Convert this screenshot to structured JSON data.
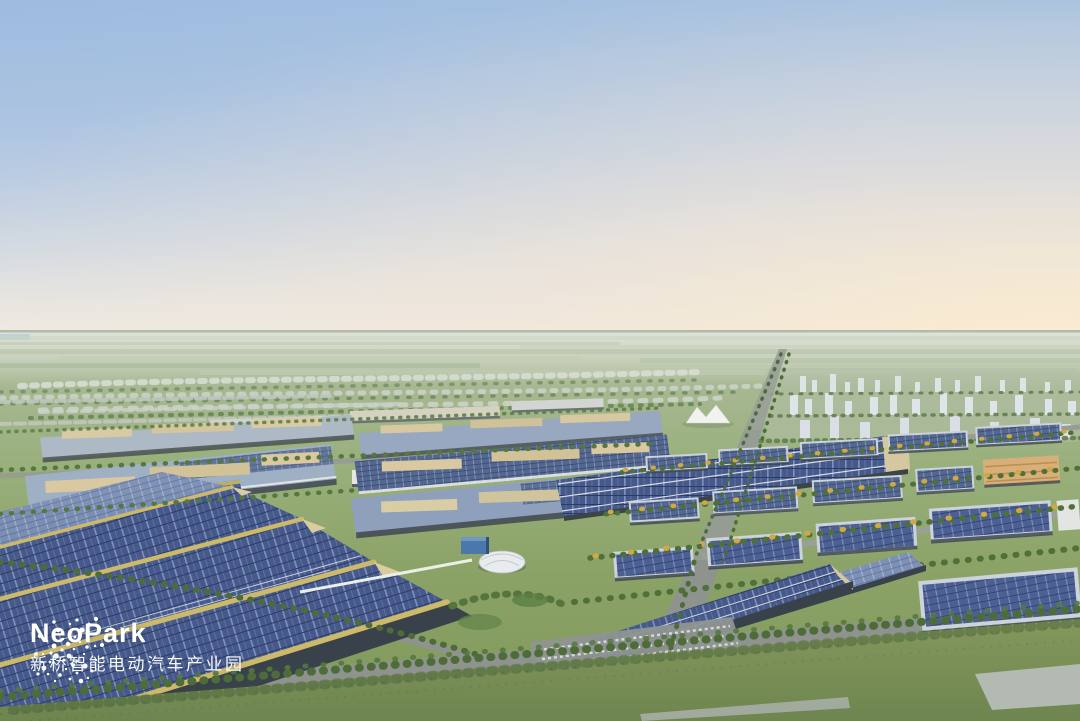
{
  "logo": {
    "title": "NeoPark",
    "subtitle": "新桥智能电动汽车产业园"
  },
  "colors": {
    "logo_white": "#ffffff",
    "sky_top": "#a9c3e1",
    "sky_horizon": "#eceae3",
    "sunset_glow": "#f9e9d2",
    "far_field": "#b9c6ab",
    "park_green": "#8aa264",
    "grass_foreground": "#7e9555",
    "tree_green": "#4d6c3a",
    "tree_autumn": "#d2a844",
    "solar_panel_dark": "#46598a",
    "solar_panel_light": "#7e93bb",
    "roof_grey_blue": "#9fb0c5",
    "wall_tan": "#d9cda6",
    "ridge_gold": "#cdb96a",
    "road_grey": "#8e928f",
    "city_white": "#dfe3e6"
  }
}
